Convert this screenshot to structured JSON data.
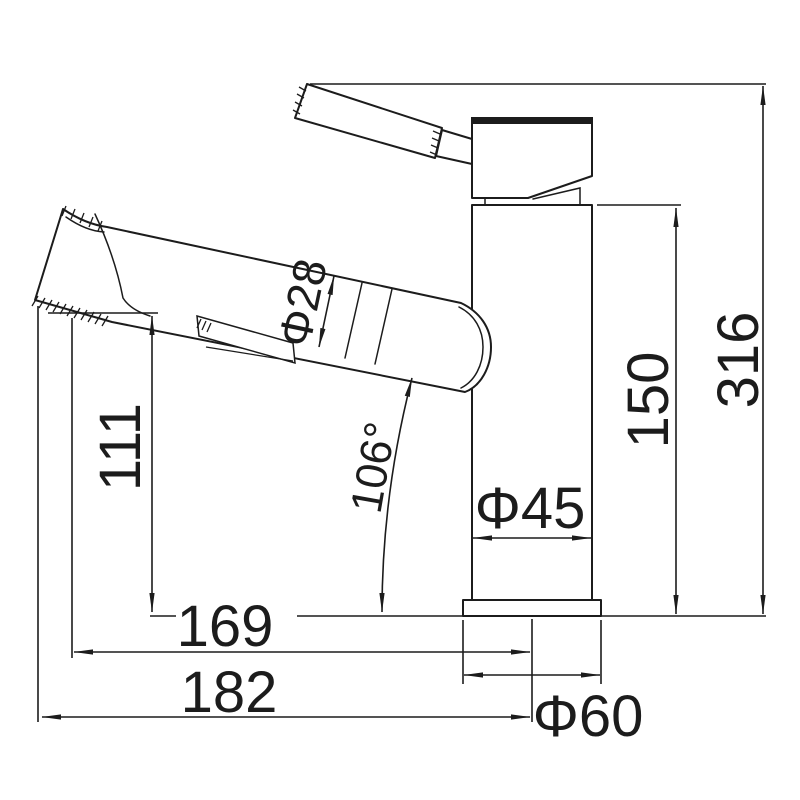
{
  "drawing": {
    "background": "#ffffff",
    "stroke_color": "#1c1c1c",
    "labels": {
      "total_height": "316",
      "upper_body_height": "150",
      "body_diameter": "Φ45",
      "base_diameter": "Φ60",
      "outlet_height": "111",
      "reach_to_outlet": "169",
      "total_reach": "182",
      "spout_diameter": "Φ28",
      "spout_angle": "106°"
    }
  }
}
